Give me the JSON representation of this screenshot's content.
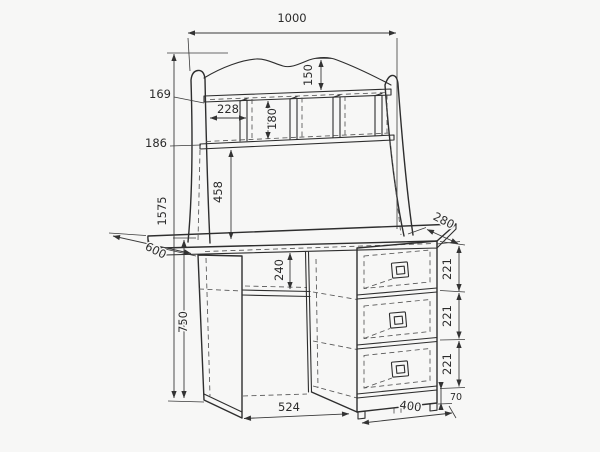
{
  "figure": {
    "type": "furniture-technical-drawing",
    "subject": "desk with shelf hutch and three-drawer pedestal"
  },
  "dimensions": {
    "hutch_width": "1000",
    "crest_height": "150",
    "top_shelf_drop": "169",
    "compartment_width": "228",
    "divider_height": "180",
    "shelf_gap": "186",
    "hutch_clearance": "458",
    "total_height": "1575",
    "desk_depth": "600",
    "hutch_depth": "280",
    "niche_height": "240",
    "desk_height": "750",
    "kneehole_width": "524",
    "drawer_heights": [
      "221",
      "221",
      "221"
    ],
    "plinth_height": "70",
    "pedestal_width": "400"
  }
}
